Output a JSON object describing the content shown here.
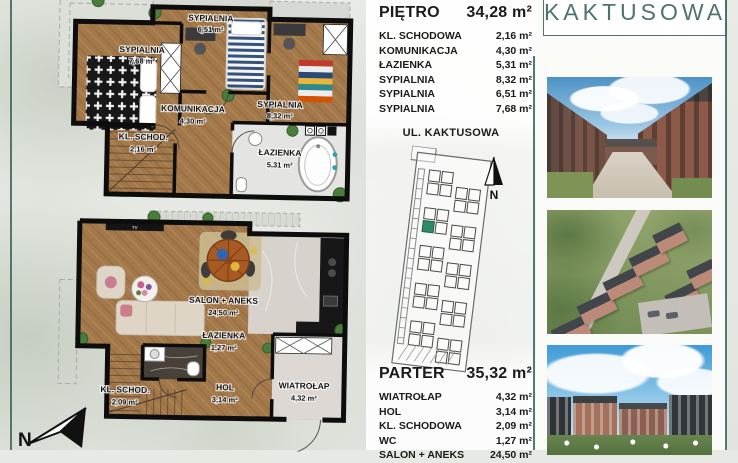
{
  "accent": {
    "teal": "#3c6e60",
    "logo_color": "#4e7370",
    "highlight_green": "#2f8a68"
  },
  "logo": {
    "text": "KAKTUSOWA"
  },
  "street": {
    "label": "UL. KAKTUSOWA"
  },
  "compass": {
    "main_label": "N",
    "site_label": "N"
  },
  "upper_floor": {
    "title": "PIĘTRO",
    "total_area": "34,28 m²",
    "rooms": [
      {
        "label": "KL. SCHODOWA",
        "area": "2,16 m²"
      },
      {
        "label": "KOMUNIKACJA",
        "area": "4,30 m²"
      },
      {
        "label": "ŁAZIENKA",
        "area": "5,31 m²"
      },
      {
        "label": "SYPIALNIA",
        "area": "8,32 m²"
      },
      {
        "label": "SYPIALNIA",
        "area": "6,51 m²"
      },
      {
        "label": "SYPIALNIA",
        "area": "7,68 m²"
      }
    ],
    "plan": {
      "bedroom_left": {
        "name": "SYPIALNIA",
        "area": "7,68 m²"
      },
      "bedroom_mid": {
        "name": "SYPIALNIA",
        "area": "6,51 m²"
      },
      "bedroom_right": {
        "name": "SYPIALNIA",
        "area": "8,32 m²"
      },
      "hall": {
        "name": "KOMUNIKACJA",
        "area": "4,30 m²"
      },
      "stairs": {
        "name": "KL. SCHOD.",
        "area": "2,16 m²"
      },
      "bath": {
        "name": "ŁAZIENKA",
        "area": "5,31 m²"
      }
    }
  },
  "ground_floor": {
    "title": "PARTER",
    "total_area": "35,32 m²",
    "rooms": [
      {
        "label": "WIATROŁAP",
        "area": "4,32 m²"
      },
      {
        "label": "HOL",
        "area": "3,14 m²"
      },
      {
        "label": "KL. SCHODOWA",
        "area": "2,09 m²"
      },
      {
        "label": "WC",
        "area": "1,27 m²"
      },
      {
        "label": "SALON + ANEKS",
        "area": "24,50 m²"
      }
    ],
    "plan": {
      "living": {
        "name": "SALON + ANEKS",
        "area": "24,50 m²"
      },
      "bath": {
        "name": "ŁAZIENKA",
        "area": "1,27 m²"
      },
      "hall": {
        "name": "HOL",
        "area": "3,14 m²"
      },
      "stairs": {
        "name": "KL. SCHOD.",
        "area": "2,09 m²"
      },
      "vestibule": {
        "name": "WIATROŁAP",
        "area": "4,32 m²"
      },
      "tv": "TV"
    }
  }
}
